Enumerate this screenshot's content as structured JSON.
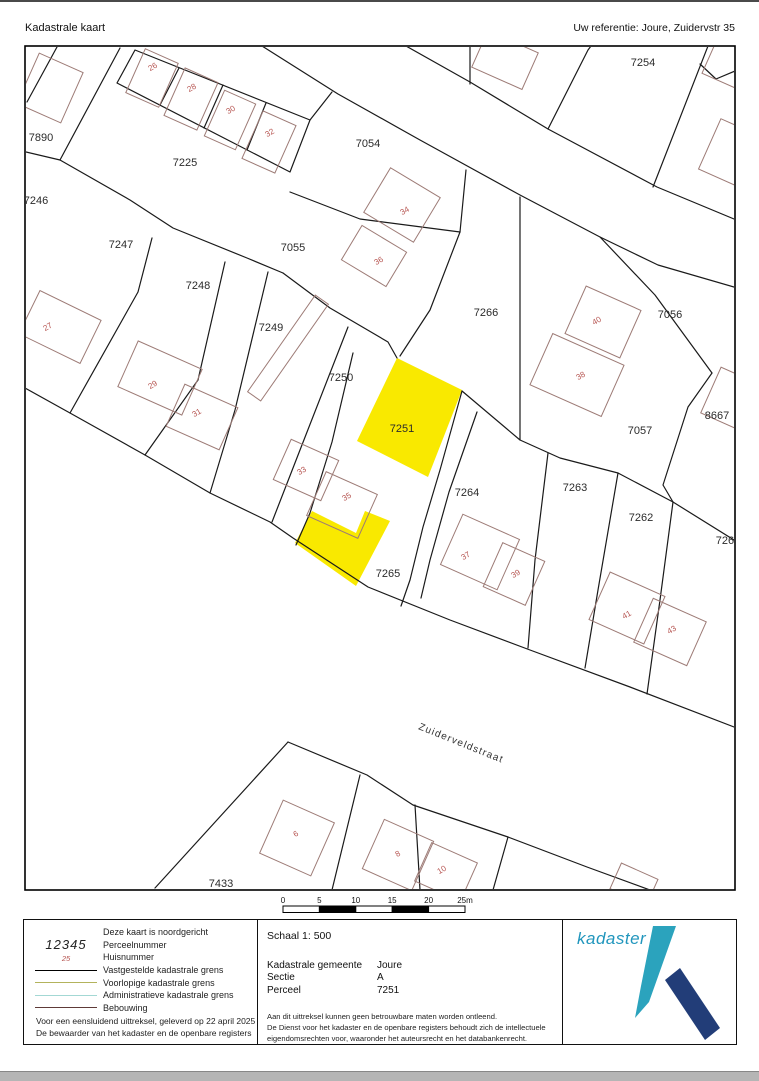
{
  "page": {
    "title_left": "Kadastrale kaart",
    "title_right": "Uw referentie: Joure, Zuidervstr 35"
  },
  "colors": {
    "highlight_yellow": "#f9e900",
    "house_number_red": "#b5524e",
    "building_outline": "#9d7b76",
    "logo_teal": "#2ba3bd",
    "logo_navy": "#223d78",
    "logo_text_blue": "#2196bd"
  },
  "map": {
    "street": {
      "text": "Zuiderveldstraat",
      "x": 460,
      "y": 746,
      "rot": 22
    },
    "highlighted_parcel": "7251",
    "parcel_labels": [
      {
        "text": "7890",
        "x": 41,
        "y": 141
      },
      {
        "text": "7225",
        "x": 185,
        "y": 166
      },
      {
        "text": "7054",
        "x": 368,
        "y": 147
      },
      {
        "text": "7254",
        "x": 643,
        "y": 66
      },
      {
        "text": "7246",
        "x": 36,
        "y": 204
      },
      {
        "text": "7247",
        "x": 121,
        "y": 248
      },
      {
        "text": "7055",
        "x": 293,
        "y": 251
      },
      {
        "text": "7248",
        "x": 198,
        "y": 289
      },
      {
        "text": "7249",
        "x": 271,
        "y": 331
      },
      {
        "text": "7250",
        "x": 341,
        "y": 381
      },
      {
        "text": "7266",
        "x": 486,
        "y": 316
      },
      {
        "text": "7056",
        "x": 670,
        "y": 318
      },
      {
        "text": "7057",
        "x": 640,
        "y": 434
      },
      {
        "text": "8667",
        "x": 717,
        "y": 419
      },
      {
        "text": "7251",
        "x": 402,
        "y": 432
      },
      {
        "text": "7264",
        "x": 467,
        "y": 496
      },
      {
        "text": "7263",
        "x": 575,
        "y": 491
      },
      {
        "text": "7262",
        "x": 641,
        "y": 521
      },
      {
        "text": "7261",
        "x": 728,
        "y": 544
      },
      {
        "text": "7265",
        "x": 388,
        "y": 577
      },
      {
        "text": "7433",
        "x": 221,
        "y": 887
      }
    ],
    "house_numbers": [
      {
        "text": "26",
        "x": 154,
        "y": 69
      },
      {
        "text": "28",
        "x": 193,
        "y": 90
      },
      {
        "text": "30",
        "x": 232,
        "y": 112
      },
      {
        "text": "32",
        "x": 271,
        "y": 135
      },
      {
        "text": "34",
        "x": 406,
        "y": 213
      },
      {
        "text": "36",
        "x": 380,
        "y": 263
      },
      {
        "text": "27",
        "x": 49,
        "y": 329
      },
      {
        "text": "29",
        "x": 154,
        "y": 387
      },
      {
        "text": "31",
        "x": 198,
        "y": 415
      },
      {
        "text": "33",
        "x": 303,
        "y": 473
      },
      {
        "text": "35",
        "x": 348,
        "y": 499
      },
      {
        "text": "37",
        "x": 467,
        "y": 558
      },
      {
        "text": "39",
        "x": 517,
        "y": 576
      },
      {
        "text": "40",
        "x": 598,
        "y": 323
      },
      {
        "text": "38",
        "x": 582,
        "y": 378
      },
      {
        "text": "41",
        "x": 628,
        "y": 617
      },
      {
        "text": "43",
        "x": 673,
        "y": 632
      },
      {
        "text": "6",
        "x": 297,
        "y": 836
      },
      {
        "text": "8",
        "x": 399,
        "y": 856
      },
      {
        "text": "10",
        "x": 443,
        "y": 872
      }
    ]
  },
  "scalebar": {
    "labels": [
      "0",
      "5",
      "10",
      "15",
      "20",
      "25m"
    ]
  },
  "footer": {
    "scale_label": "Schaal 1: 500",
    "logo_text": "kadaster",
    "legend_rows": [
      {
        "type": "note",
        "sample": "",
        "label": "Deze kaart is noordgericht"
      },
      {
        "type": "text",
        "cls": "sample-perceel",
        "sample": "12345",
        "label": "Perceelnummer"
      },
      {
        "type": "text",
        "cls": "sample-huis",
        "sample": "25",
        "label": "Huisnummer"
      },
      {
        "type": "line",
        "color": "#000000",
        "thick": 1.5,
        "label": "Vastgestelde kadastrale grens"
      },
      {
        "type": "line",
        "color": "#b3b35c",
        "thick": 1.2,
        "label": "Voorlopige kadastrale grens"
      },
      {
        "type": "line",
        "color": "#a3d8d4",
        "thick": 1.2,
        "label": "Administratieve kadastrale grens"
      },
      {
        "type": "line",
        "color": "#5e3a38",
        "thick": 1.5,
        "label": "Bebouwing"
      }
    ],
    "left_disclaimer": [
      "Voor een eensluidend uittreksel, geleverd op 22 april 2025",
      "De bewaarder van het kadaster en de openbare registers"
    ],
    "info_rows": [
      {
        "label": "Kadastrale gemeente",
        "value": "Joure"
      },
      {
        "label": "Sectie",
        "value": "A"
      },
      {
        "label": "Perceel",
        "value": "7251"
      }
    ],
    "mid_disclaimer": [
      "Aan dit uittreksel kunnen geen betrouwbare maten worden ontleend.",
      "De Dienst voor het kadaster en de openbare registers behoudt zich de intellectuele",
      "eigendomsrechten voor, waaronder het auteursrecht en het databankenrecht."
    ]
  }
}
